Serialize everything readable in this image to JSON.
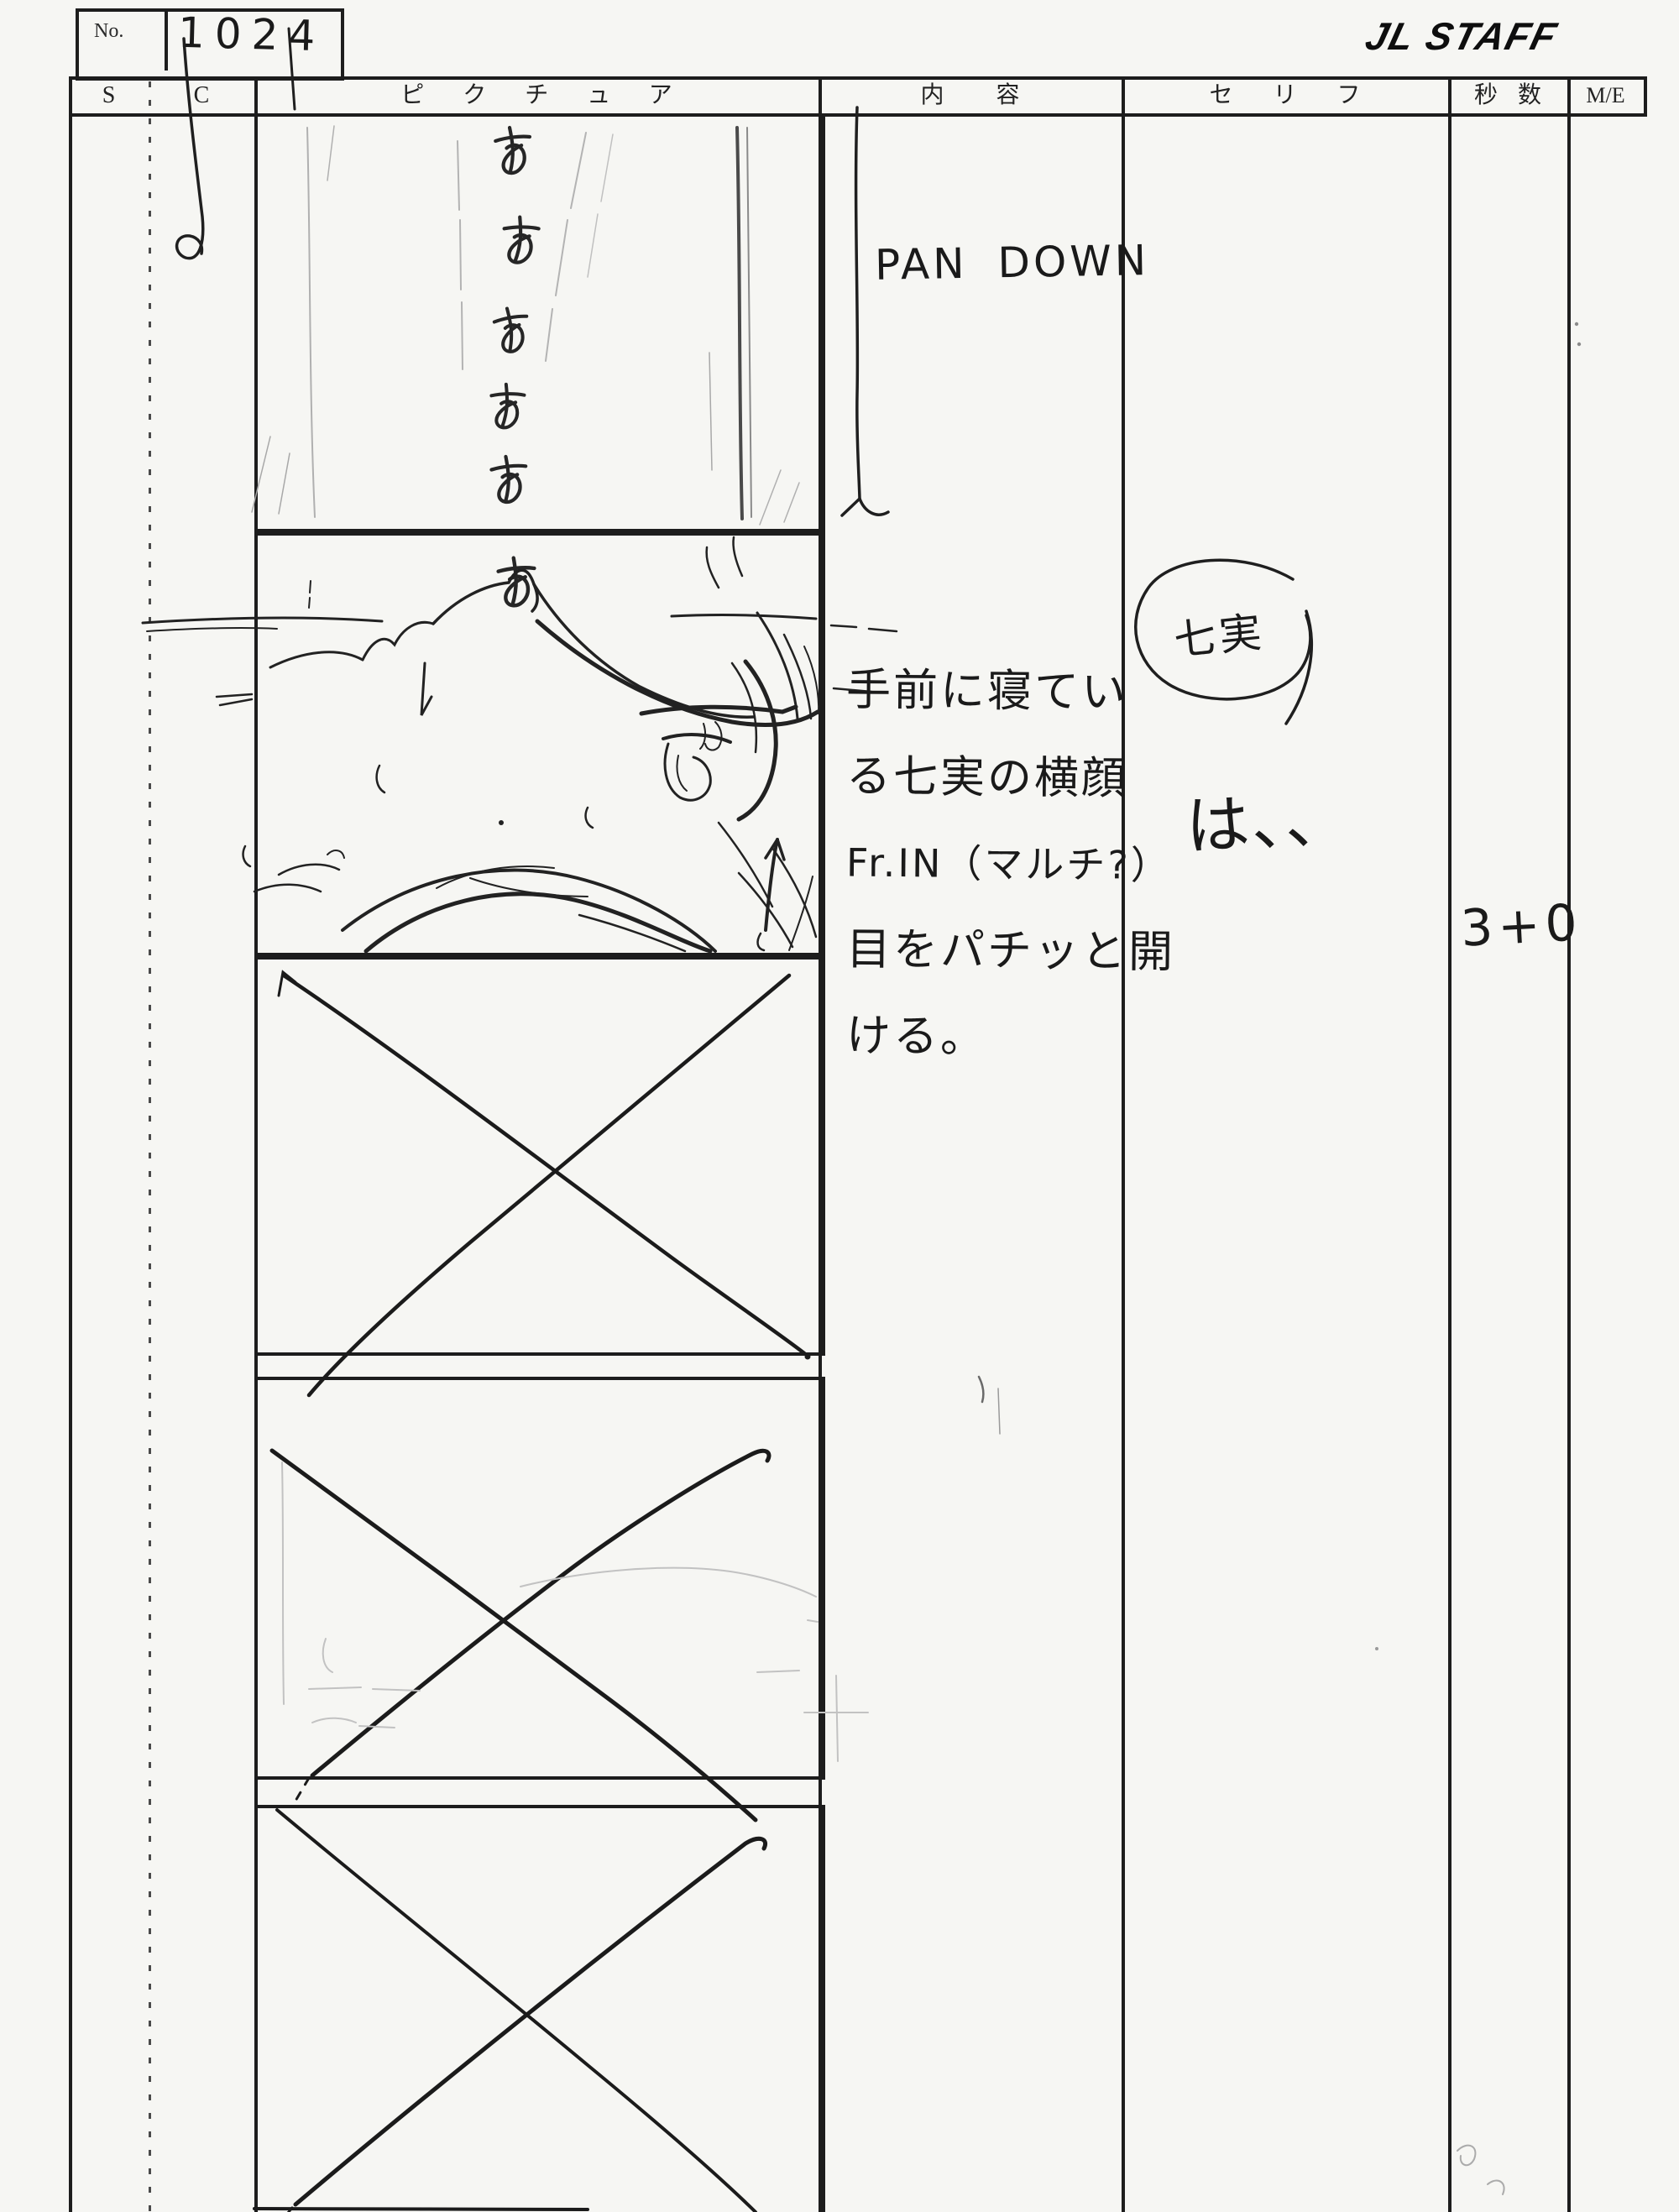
{
  "sheet": {
    "no_label": "No.",
    "no_value": "1024",
    "logo": "JL STAFF"
  },
  "table_headers": {
    "s": "S",
    "c": "C",
    "picture": "ピクチュア",
    "content": "内容",
    "dialogue": "セリフ",
    "seconds": "秒数",
    "me": "M/E"
  },
  "content_column": {
    "camera_note": "PAN DOWN",
    "action_lines": [
      "手前に寝てい",
      "る七実の横顔",
      "Fr.IN（マルチ?）",
      "目をパチッと開",
      "ける。"
    ]
  },
  "dialogue_column": {
    "character_name": "七実",
    "line": "は、、"
  },
  "seconds_column": {
    "duration": "3+0"
  },
  "picture_column": {
    "panel1_sketch_marks": [
      "あ",
      "あ",
      "あ",
      "あ",
      "あ"
    ],
    "panel2_sketch_mark": "あ"
  }
}
